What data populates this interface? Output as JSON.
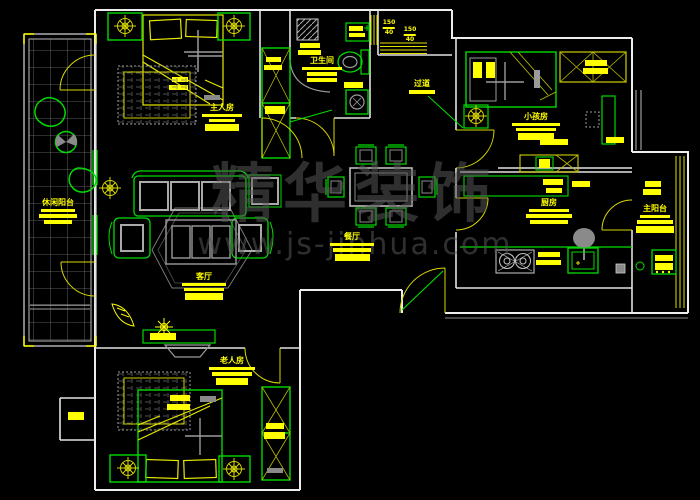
{
  "title": "apartment-floor-plan",
  "watermark": {
    "brand": "精华装饰",
    "url": "www.js-jinhua.com"
  },
  "rooms": {
    "master_bedroom": {
      "label": "主人房"
    },
    "bathroom": {
      "label": "卫生间"
    },
    "corridor": {
      "label": "过道"
    },
    "kids_room": {
      "label": "小孩房"
    },
    "kitchen": {
      "label": "厨房"
    },
    "dining": {
      "label": "餐厅"
    },
    "living": {
      "label": "客厅"
    },
    "leisure_balcony": {
      "label": "休闲阳台"
    },
    "main_balcony": {
      "label": "主阳台"
    },
    "elder_room": {
      "label": "老人房"
    }
  },
  "dims": [
    {
      "v": "150",
      "s": "40"
    },
    {
      "v": "150",
      "s": "40"
    }
  ],
  "colors": {
    "background": "#000000",
    "wall_white": "#ededed",
    "furniture_green": "#00dc00",
    "accent_yellow": "#ffff00",
    "door_yellow": "#d8d800",
    "grid_gray": "#9b9b9b",
    "watermark_gray": "#575757"
  }
}
